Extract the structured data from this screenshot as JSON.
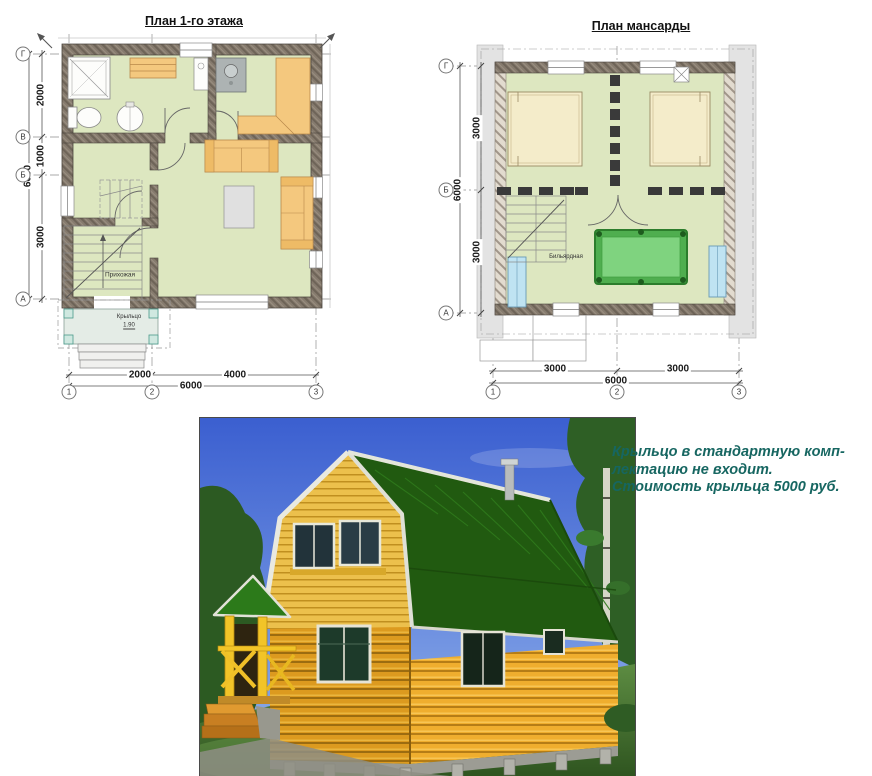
{
  "plan_first_floor": {
    "title": "План 1-го этажа",
    "axis_letters": [
      "Г",
      "В",
      "Б",
      "А"
    ],
    "axis_numbers": [
      "1",
      "2",
      "3"
    ],
    "dim_vertical": [
      "2000",
      "1000",
      "3000"
    ],
    "dim_vertical_total": "6000",
    "dim_horizontal": [
      "2000",
      "4000"
    ],
    "dim_horizontal_total": "6000",
    "room_hallway": "Прихожая",
    "room_porch": "Крыльцо",
    "porch_level": "1.90"
  },
  "plan_attic": {
    "title": "План мансарды",
    "axis_letters": [
      "Г",
      "Б",
      "А"
    ],
    "axis_numbers": [
      "1",
      "2",
      "3"
    ],
    "dim_vertical": [
      "3000",
      "3000"
    ],
    "dim_vertical_total": "6000",
    "dim_horizontal": [
      "3000",
      "3000"
    ],
    "dim_horizontal_total": "6000",
    "room_billiard": "Бильярдная"
  },
  "note": {
    "line1": "Крыльцо в стандартную комп-",
    "line2": "лектацию не входит.",
    "line3": "Стоимость крыльца 5000 руб."
  },
  "colors": {
    "note_text": "#166661",
    "plan_room_fill": "#dde7c0",
    "furniture_orange": "#f4c87e",
    "billiard_green": "#4fae4f",
    "roof_green": "#215a10",
    "log_wall": "#efae2e",
    "sky_blue": "#3b5fd0"
  }
}
